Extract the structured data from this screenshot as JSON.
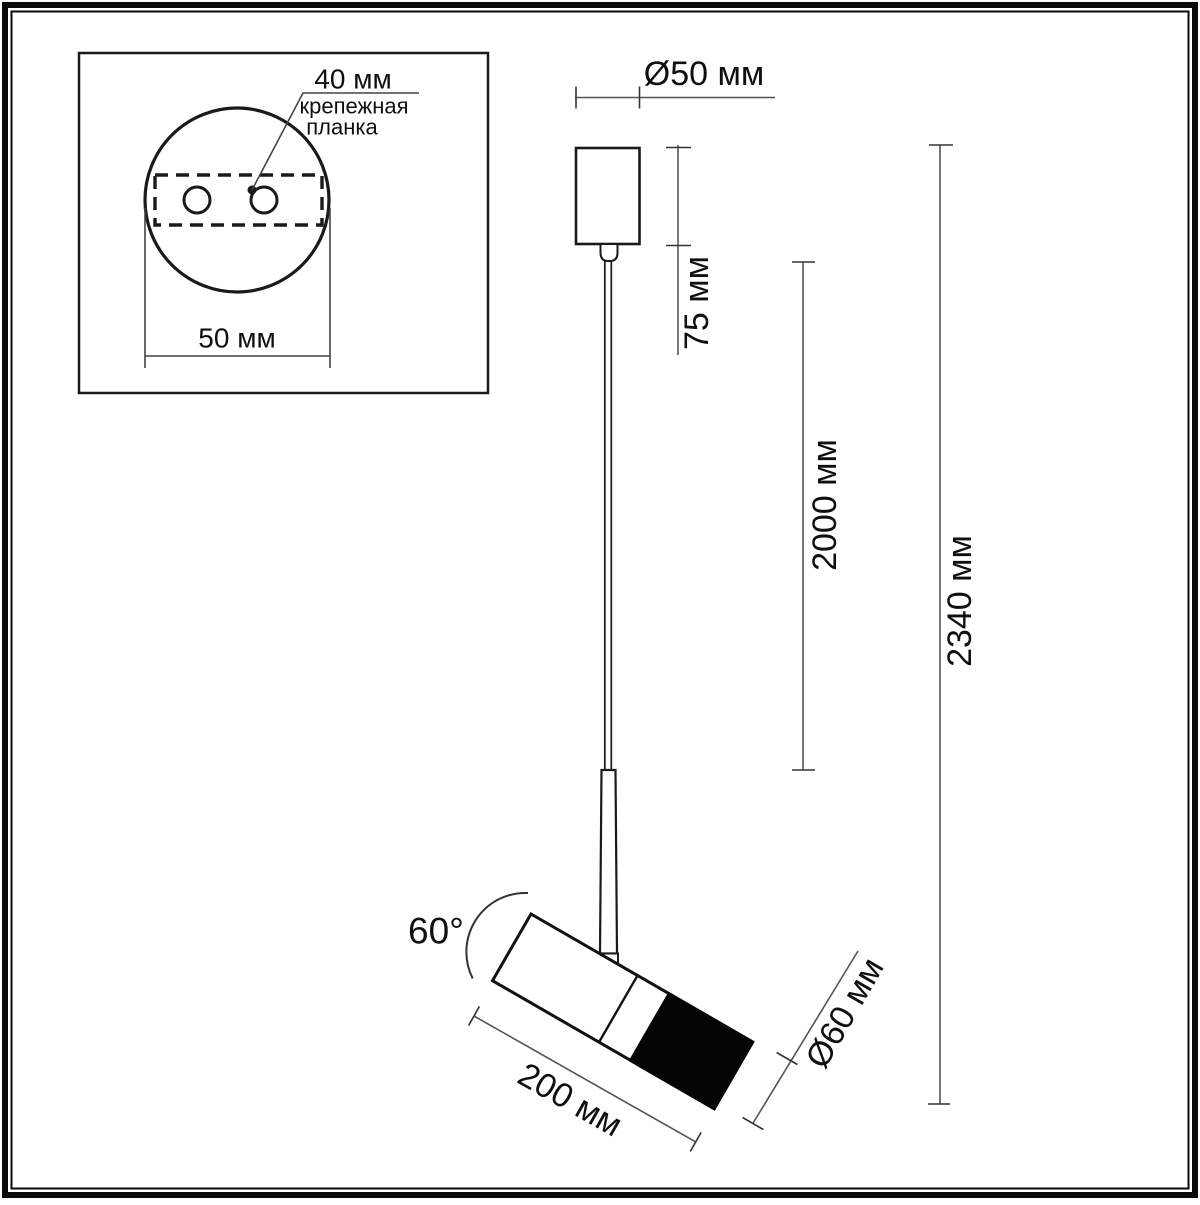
{
  "diagram": {
    "kind": "technical-dimension-drawing",
    "subject": "pendant spotlight",
    "colors": {
      "background": "#ffffff",
      "outline": "#1a1a1a",
      "dimension_line": "#555555",
      "tick": "#333333",
      "head_front_fill": "#050505"
    },
    "inset": {
      "hole_spacing_label": "40 мм",
      "plate_label_line1": "крепежная",
      "plate_label_line2": "планка",
      "canopy_width_label": "50 мм"
    },
    "dimensions": {
      "canopy_diameter": "Ø50 мм",
      "canopy_height": "75 мм",
      "cable_length": "2000 мм",
      "total_height": "2340 мм",
      "tilt_angle": "60°",
      "head_length": "200 мм",
      "head_diameter": "Ø60 мм"
    }
  }
}
